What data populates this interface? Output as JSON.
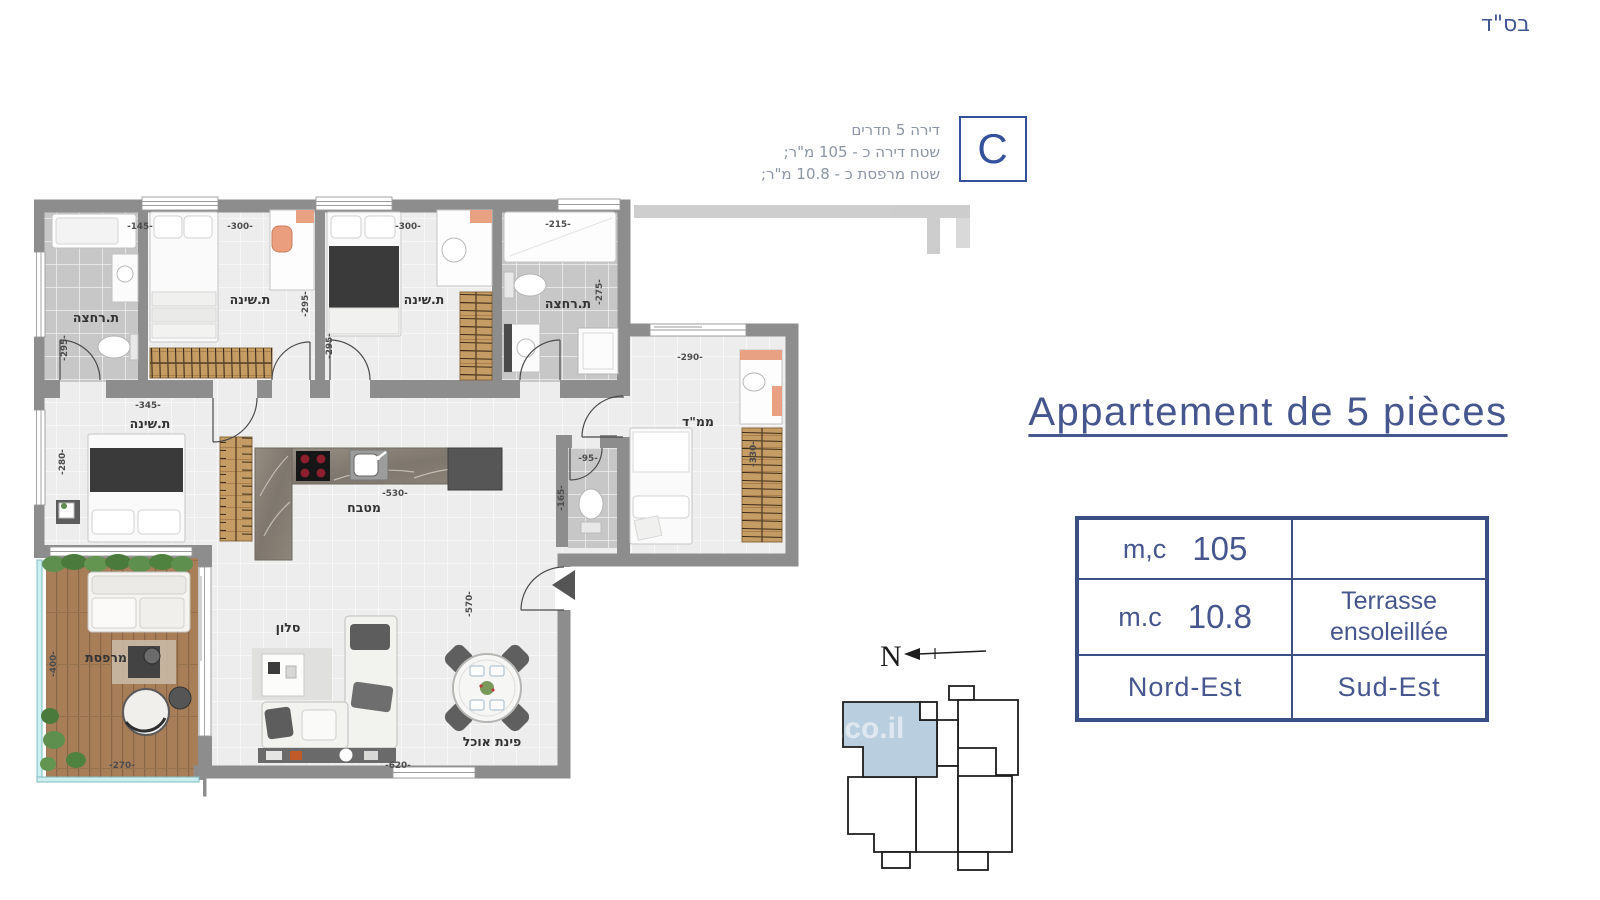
{
  "page": {
    "bsd": "בס\"ד",
    "watermark": ".co.il"
  },
  "summary": {
    "unit_letter": "C",
    "lines": [
      "דירה 5 חדרים",
      "שטח דירה כ - 105 מ\"ר;",
      "שטח מרפסת כ - 10.8 מ\"ר;"
    ]
  },
  "title": {
    "text": "Appartement de 5 pièces"
  },
  "spec_table": {
    "rows": {
      "r1": {
        "label": "m,c",
        "value": "105",
        "right": ""
      },
      "r2": {
        "label": "m.c",
        "value": "10.8",
        "right_line1": "Terrasse",
        "right_line2": "ensoleillée"
      },
      "r3": {
        "left": "Nord-Est",
        "right": "Sud-Est"
      }
    }
  },
  "compass": {
    "north": "N"
  },
  "plan": {
    "rooms": {
      "bath1": "ת.רחצה",
      "bed1": "ת.שינה",
      "bed2": "ת.שינה",
      "bath2": "ת.רחצה",
      "master": "ת.שינה",
      "mamad": "ממ\"ד",
      "kitchen": "מטבח",
      "salon": "סלון",
      "dining": "פינת אוכל",
      "terrace": "מרפסת"
    },
    "dims": {
      "bath1_w": "-145-",
      "bath1_h": "-295-",
      "bed1_w": "-300-",
      "bed1_h": "-295-",
      "bed2_w": "-300-",
      "bed2_h": "-295-",
      "bath2_w": "-215-",
      "bath2_h": "-275-",
      "master_w": "-345-",
      "master_h": "-280-",
      "kitchen_w": "-530-",
      "living_h": "-570-",
      "living_w": "-620-",
      "wc_w": "-95-",
      "wc_h": "-165-",
      "mamad_w": "-290-",
      "mamad_h": "-330-",
      "terrace_h": "-400-",
      "terrace_w": "-270-"
    }
  },
  "colors": {
    "accent": "#46568e",
    "wall": "#8d8d8d",
    "highlight_unit": "#b9cedf"
  }
}
